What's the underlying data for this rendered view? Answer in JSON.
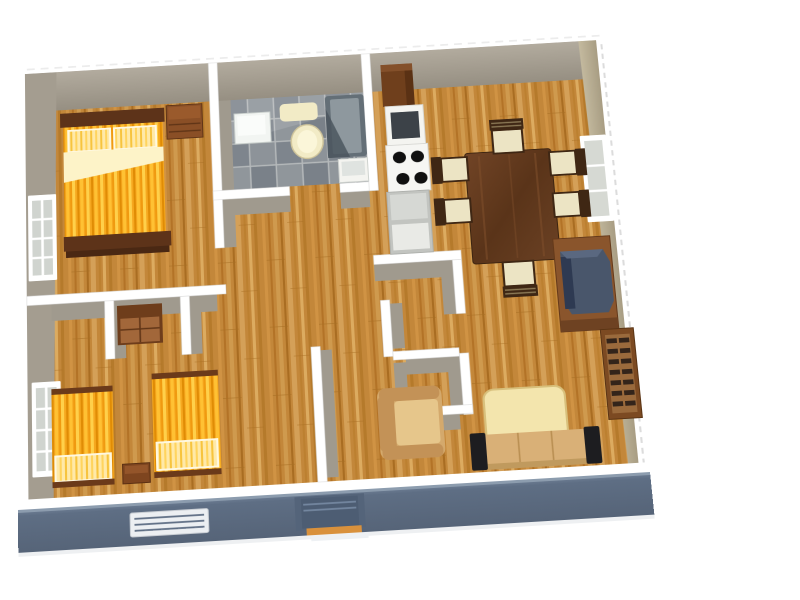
{
  "scene": {
    "type": "3d-rendered-apartment-floor-plan",
    "view": "tilted top-down",
    "background": "#ffffff",
    "visible_text": []
  },
  "palette": {
    "wall_top": "#ffffff",
    "wall_face": "#a49d90",
    "wall_face_east": "#b9ae96",
    "exterior_front": "#5e6e84",
    "wood": "#c3873a",
    "tile": "#8b9196",
    "bed_yellow": "#f6a81f",
    "pillow_cream": "#fdf3c8",
    "bed_frame": "#5d3319",
    "dresser_brown": "#8a4f26",
    "table_walnut": "#5f3a1f",
    "chair_seat": "#ece4c4",
    "chair_frame": "#3f2714",
    "tv_body": "#49566b",
    "tv_screen": "#2e3a52",
    "cabinet_brown": "#8a552c",
    "shelf_slat": "#33241a",
    "sofa_tan": "#d9b077",
    "sofa_arm_black": "#1d1d20",
    "coffee_table_cream": "#f3e5ad",
    "armchair_tan": "#d4a96c",
    "fridge_brown": "#6f3f1c",
    "appliance_white": "#f4f4f0",
    "burner_black": "#101010",
    "counter_gray": "#c2c4c0",
    "sink_white": "#f2f5f2",
    "fixture_cream": "#f2ebc6",
    "tub_gray": "#646f77",
    "door_slate": "#4d5d73",
    "threshold_orange": "#d9913c",
    "window_pane": "#d0d4cf",
    "grille_white": "#eceff2"
  },
  "rooms": [
    {
      "name": "bedroom-1",
      "position": "top-left",
      "floor": "hardwood"
    },
    {
      "name": "bathroom",
      "position": "top-center",
      "floor": "gray-tile"
    },
    {
      "name": "kitchen",
      "position": "top-center-right",
      "floor": "hardwood"
    },
    {
      "name": "living-dining-room",
      "position": "right",
      "floor": "hardwood"
    },
    {
      "name": "hallway",
      "position": "center",
      "floor": "hardwood"
    },
    {
      "name": "closets",
      "position": "center",
      "floor": "hardwood"
    },
    {
      "name": "bedroom-2",
      "position": "bottom-left",
      "floor": "hardwood"
    }
  ],
  "furniture": {
    "bedroom-1": [
      "double-bed-yellow",
      "nightstand"
    ],
    "bathroom": [
      "sink",
      "bath-mat",
      "toilet",
      "bathtub",
      "cabinet"
    ],
    "kitchen": [
      "refrigerator",
      "oven",
      "cooktop-4-burners",
      "counter"
    ],
    "living-dining-room": [
      "dining-table",
      "six-chairs",
      "tv-stand",
      "crt-tv",
      "wall-shelf",
      "coffee-table",
      "armchair",
      "sofa"
    ],
    "bedroom-2": [
      "single-bed-yellow-left",
      "single-bed-yellow-right",
      "stool",
      "dresser"
    ]
  },
  "openings": {
    "windows": [
      "west-wall-bedroom-1",
      "west-wall-bedroom-2",
      "east-wall-living-room"
    ],
    "front_wall": [
      "vent-grille",
      "front-door-with-step"
    ]
  }
}
